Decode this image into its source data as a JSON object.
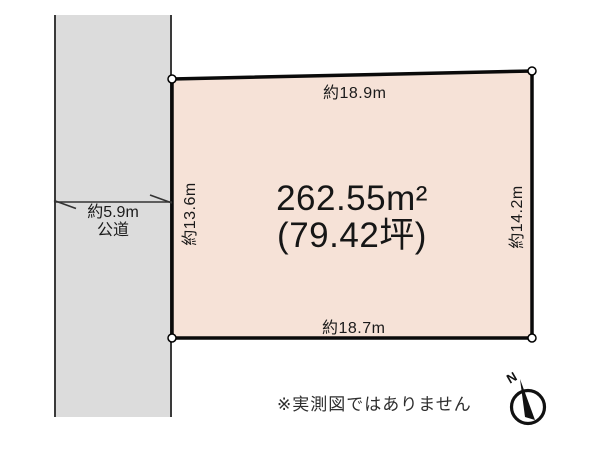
{
  "plot": {
    "area_m2": "262.55m²",
    "area_tsubo": "(79.42坪)",
    "dim_top": "約18.9m",
    "dim_bottom": "約18.7m",
    "dim_left": "約13.6m",
    "dim_right": "約14.2m"
  },
  "road": {
    "width_label": "約5.9m",
    "type_label": "公道"
  },
  "note": "※実測図ではありません",
  "compass": {
    "north_label": "N"
  },
  "colors": {
    "plot_fill": "#f6e2d7",
    "plot_stroke": "#0a0a0a",
    "road_fill": "#dcdcdc",
    "road_border": "#3a3a3a",
    "dimension_line": "#333333",
    "text": "#1a1a1a"
  }
}
